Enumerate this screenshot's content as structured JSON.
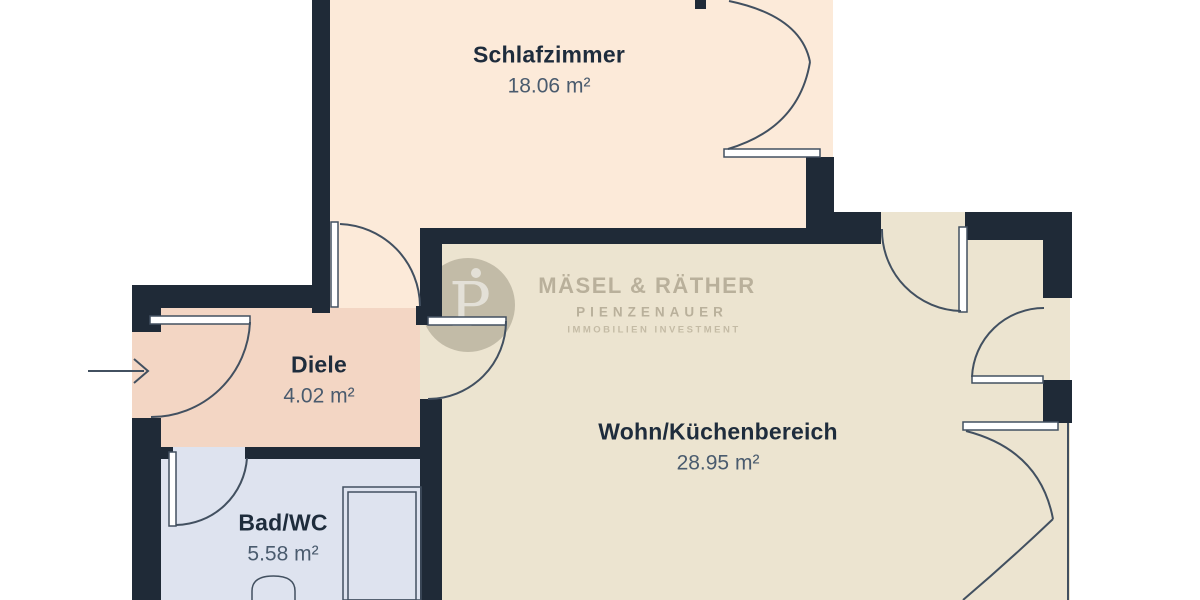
{
  "rooms": [
    {
      "id": "schlafzimmer",
      "name": "Schlafzimmer",
      "area": "18.06 m²",
      "floor_color": "#fcead9"
    },
    {
      "id": "diele",
      "name": "Diele",
      "area": "4.02 m²",
      "floor_color": "#f3d6c4"
    },
    {
      "id": "bad",
      "name": "Bad/WC",
      "area": "5.58 m²",
      "floor_color": "#dee3ef"
    },
    {
      "id": "wohn",
      "name": "Wohn/Küchenbereich",
      "area": "28.95 m²",
      "floor_color": "#ece4d0"
    }
  ],
  "watermark": {
    "brand": "MÄSEL & RÄTHER",
    "sub": "PIENZENAUER",
    "tagline": "IMMOBILIEN INVESTMENT",
    "monogram": "P"
  },
  "colors": {
    "background": "#ffffff",
    "wall": "#1f2a37",
    "line": "#425060",
    "label": "#1e2c3c",
    "label_muted": "#4a5b6e",
    "wm_circle": "rgba(110,102,86,0.33)",
    "wm_glyph": "rgba(255,255,255,0.55)",
    "wm_text": "rgba(124,113,90,0.45)",
    "wm_text_light": "rgba(124,113,90,0.36)"
  }
}
